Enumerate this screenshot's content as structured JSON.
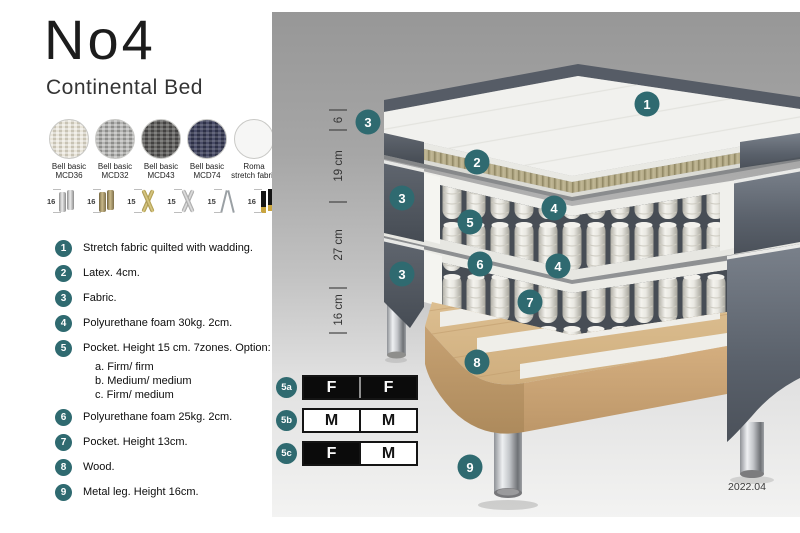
{
  "accent_color": "#2f6a70",
  "header": {
    "title": "No4",
    "subtitle": "Continental Bed"
  },
  "fabrics": [
    {
      "line1": "Bell basic",
      "line2": "MCD36",
      "color": "#d8d3c5"
    },
    {
      "line1": "Bell basic",
      "line2": "MCD32",
      "color": "#a0a09e"
    },
    {
      "line1": "Bell basic",
      "line2": "MCD43",
      "color": "#555453"
    },
    {
      "line1": "Bell basic",
      "line2": "MCD74",
      "color": "#3a3d54"
    },
    {
      "line1": "Roma",
      "line2": "stretch fabric",
      "color": "#f6f6f5"
    }
  ],
  "legs": [
    {
      "height": "16",
      "style": "cylinder-silver"
    },
    {
      "height": "16",
      "style": "cylinder-bronze"
    },
    {
      "height": "15",
      "style": "cross-gold"
    },
    {
      "height": "15",
      "style": "cross-silver"
    },
    {
      "height": "15",
      "style": "hairpin"
    },
    {
      "height": "16",
      "style": "black-gold"
    }
  ],
  "features": [
    {
      "n": "1",
      "text": "Stretch fabric quilted with wadding."
    },
    {
      "n": "2",
      "text": "Latex. 4cm."
    },
    {
      "n": "3",
      "text": "Fabric."
    },
    {
      "n": "4",
      "text": "Polyurethane foam 30kg. 2cm."
    },
    {
      "n": "5",
      "text": "Pocket. Height 15 cm. 7zones. Option:",
      "options": [
        "a. Firm/ firm",
        "b. Medium/ medium",
        "c. Firm/ medium"
      ]
    },
    {
      "n": "6",
      "text": "Polyurethane foam 25kg. 2cm."
    },
    {
      "n": "7",
      "text": "Pocket. Height 13cm."
    },
    {
      "n": "8",
      "text": "Wood."
    },
    {
      "n": "9",
      "text": "Metal leg. Height 16cm."
    }
  ],
  "diagram": {
    "dimensions": [
      "6",
      "19 cm",
      "27 cm",
      "16 cm"
    ],
    "callouts": [
      "1",
      "2",
      "3",
      "3",
      "3",
      "4",
      "4",
      "5",
      "6",
      "7",
      "8",
      "9"
    ],
    "version": "2022.04"
  },
  "firmness": [
    {
      "id": "5a",
      "cells": [
        {
          "label": "F",
          "tone": "dark"
        },
        {
          "label": "F",
          "tone": "dark"
        }
      ]
    },
    {
      "id": "5b",
      "cells": [
        {
          "label": "M",
          "tone": "light"
        },
        {
          "label": "M",
          "tone": "light"
        }
      ]
    },
    {
      "id": "5c",
      "cells": [
        {
          "label": "F",
          "tone": "dark"
        },
        {
          "label": "M",
          "tone": "light"
        }
      ]
    }
  ]
}
